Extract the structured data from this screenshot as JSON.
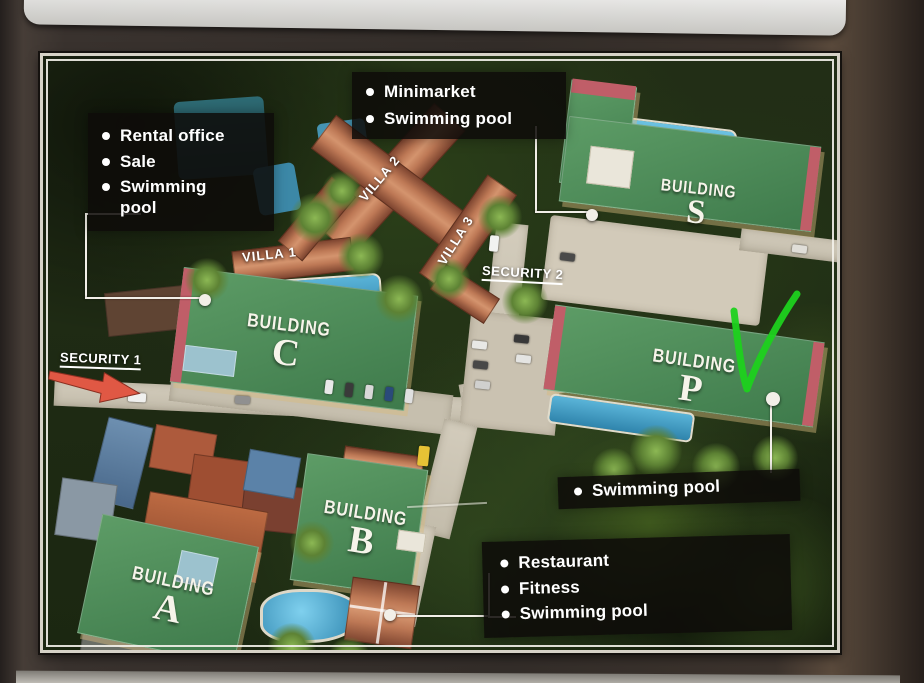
{
  "map": {
    "callouts": {
      "rental": {
        "items": [
          "Rental office",
          "Sale",
          "Swimming pool"
        ]
      },
      "minimarket": {
        "items": [
          "Minimarket",
          "Swimming pool"
        ]
      },
      "building_p": {
        "items": [
          "Swimming pool"
        ]
      },
      "restaurant": {
        "items": [
          "Restaurant",
          "Fitness",
          "Swimming pool"
        ]
      }
    },
    "buildings": [
      {
        "id": "s",
        "word": "BUILDING",
        "letter": "S"
      },
      {
        "id": "c",
        "word": "BUILDING",
        "letter": "C"
      },
      {
        "id": "p",
        "word": "BUILDING",
        "letter": "P"
      },
      {
        "id": "b",
        "word": "BUILDING",
        "letter": "B"
      },
      {
        "id": "a",
        "word": "BUILDING",
        "letter": "A"
      }
    ],
    "villas": [
      {
        "label": "VILLA 1"
      },
      {
        "label": "VILLA 2"
      },
      {
        "label": "VILLA 3"
      }
    ],
    "security": [
      {
        "label": "SECURITY 1"
      },
      {
        "label": "SECURITY 2"
      }
    ],
    "colors": {
      "callout-bg": "rgba(14,12,9,0.87)",
      "callout-text": "#ffffff",
      "roof-green": "#4a8a58",
      "roof-terracotta": "#b06a50",
      "pool-blue": "#4fa8d0",
      "road-concrete": "#cbc3b2",
      "check-green": "#1ed11e",
      "arrow-red": "#e05844",
      "line-white": "#f2efe8"
    }
  }
}
